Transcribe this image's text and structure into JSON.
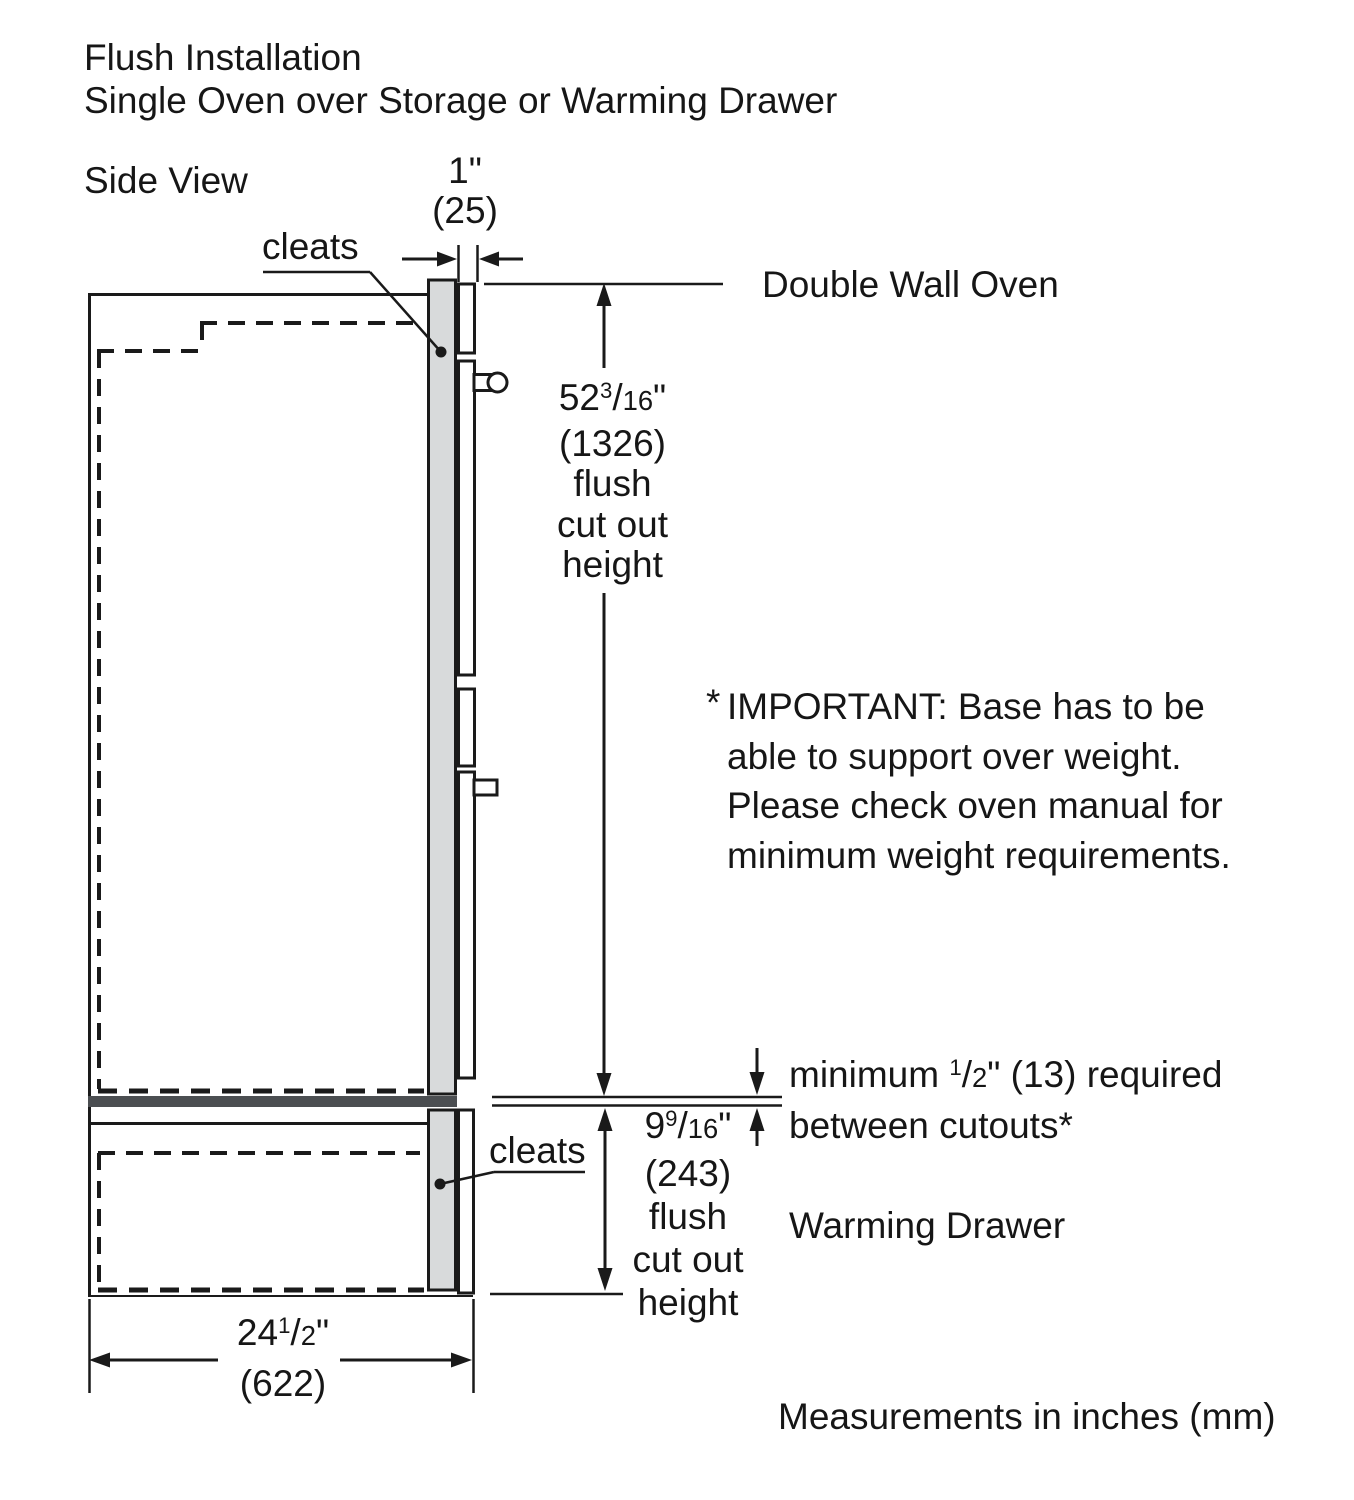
{
  "title": {
    "line1": "Flush Installation",
    "line2": "Single Oven over Storage or Warming Drawer"
  },
  "view_label": "Side View",
  "labels": {
    "cleats_top": "cleats",
    "cleats_bottom": "cleats",
    "double_wall_oven": "Double Wall Oven",
    "warming_drawer": "Warming Drawer",
    "footer": "Measurements in inches (mm)"
  },
  "dimensions": {
    "cleat_thickness": {
      "inches": "1\"",
      "mm": "(25)"
    },
    "oven_cutout": {
      "whole": "52",
      "num": "3",
      "den": "16",
      "unit": "\"",
      "mm": "(1326)",
      "desc1": "flush",
      "desc2": "cut out",
      "desc3": "height"
    },
    "drawer_cutout": {
      "whole": "9",
      "num": "9",
      "den": "16",
      "unit": "\"",
      "mm": "(243)",
      "desc1": "flush",
      "desc2": "cut out",
      "desc3": "height"
    },
    "depth": {
      "whole": "24",
      "num": "1",
      "den": "2",
      "unit": "\"",
      "mm": "(622)"
    },
    "min_gap": {
      "prefix": "minimum ",
      "num": "1",
      "den": "2",
      "suffix": "\" (13) required",
      "line2": "between cutouts*"
    }
  },
  "note": {
    "star": "*",
    "line1": "IMPORTANT: Base has to be",
    "line2": "able to support over weight.",
    "line3": "Please check oven manual for",
    "line4": "minimum weight requirements."
  },
  "colors": {
    "line": "#1a1a1a",
    "cleat_fill": "#d8dadb",
    "base_bar_fill": "#4b4e51",
    "background": "#ffffff"
  }
}
